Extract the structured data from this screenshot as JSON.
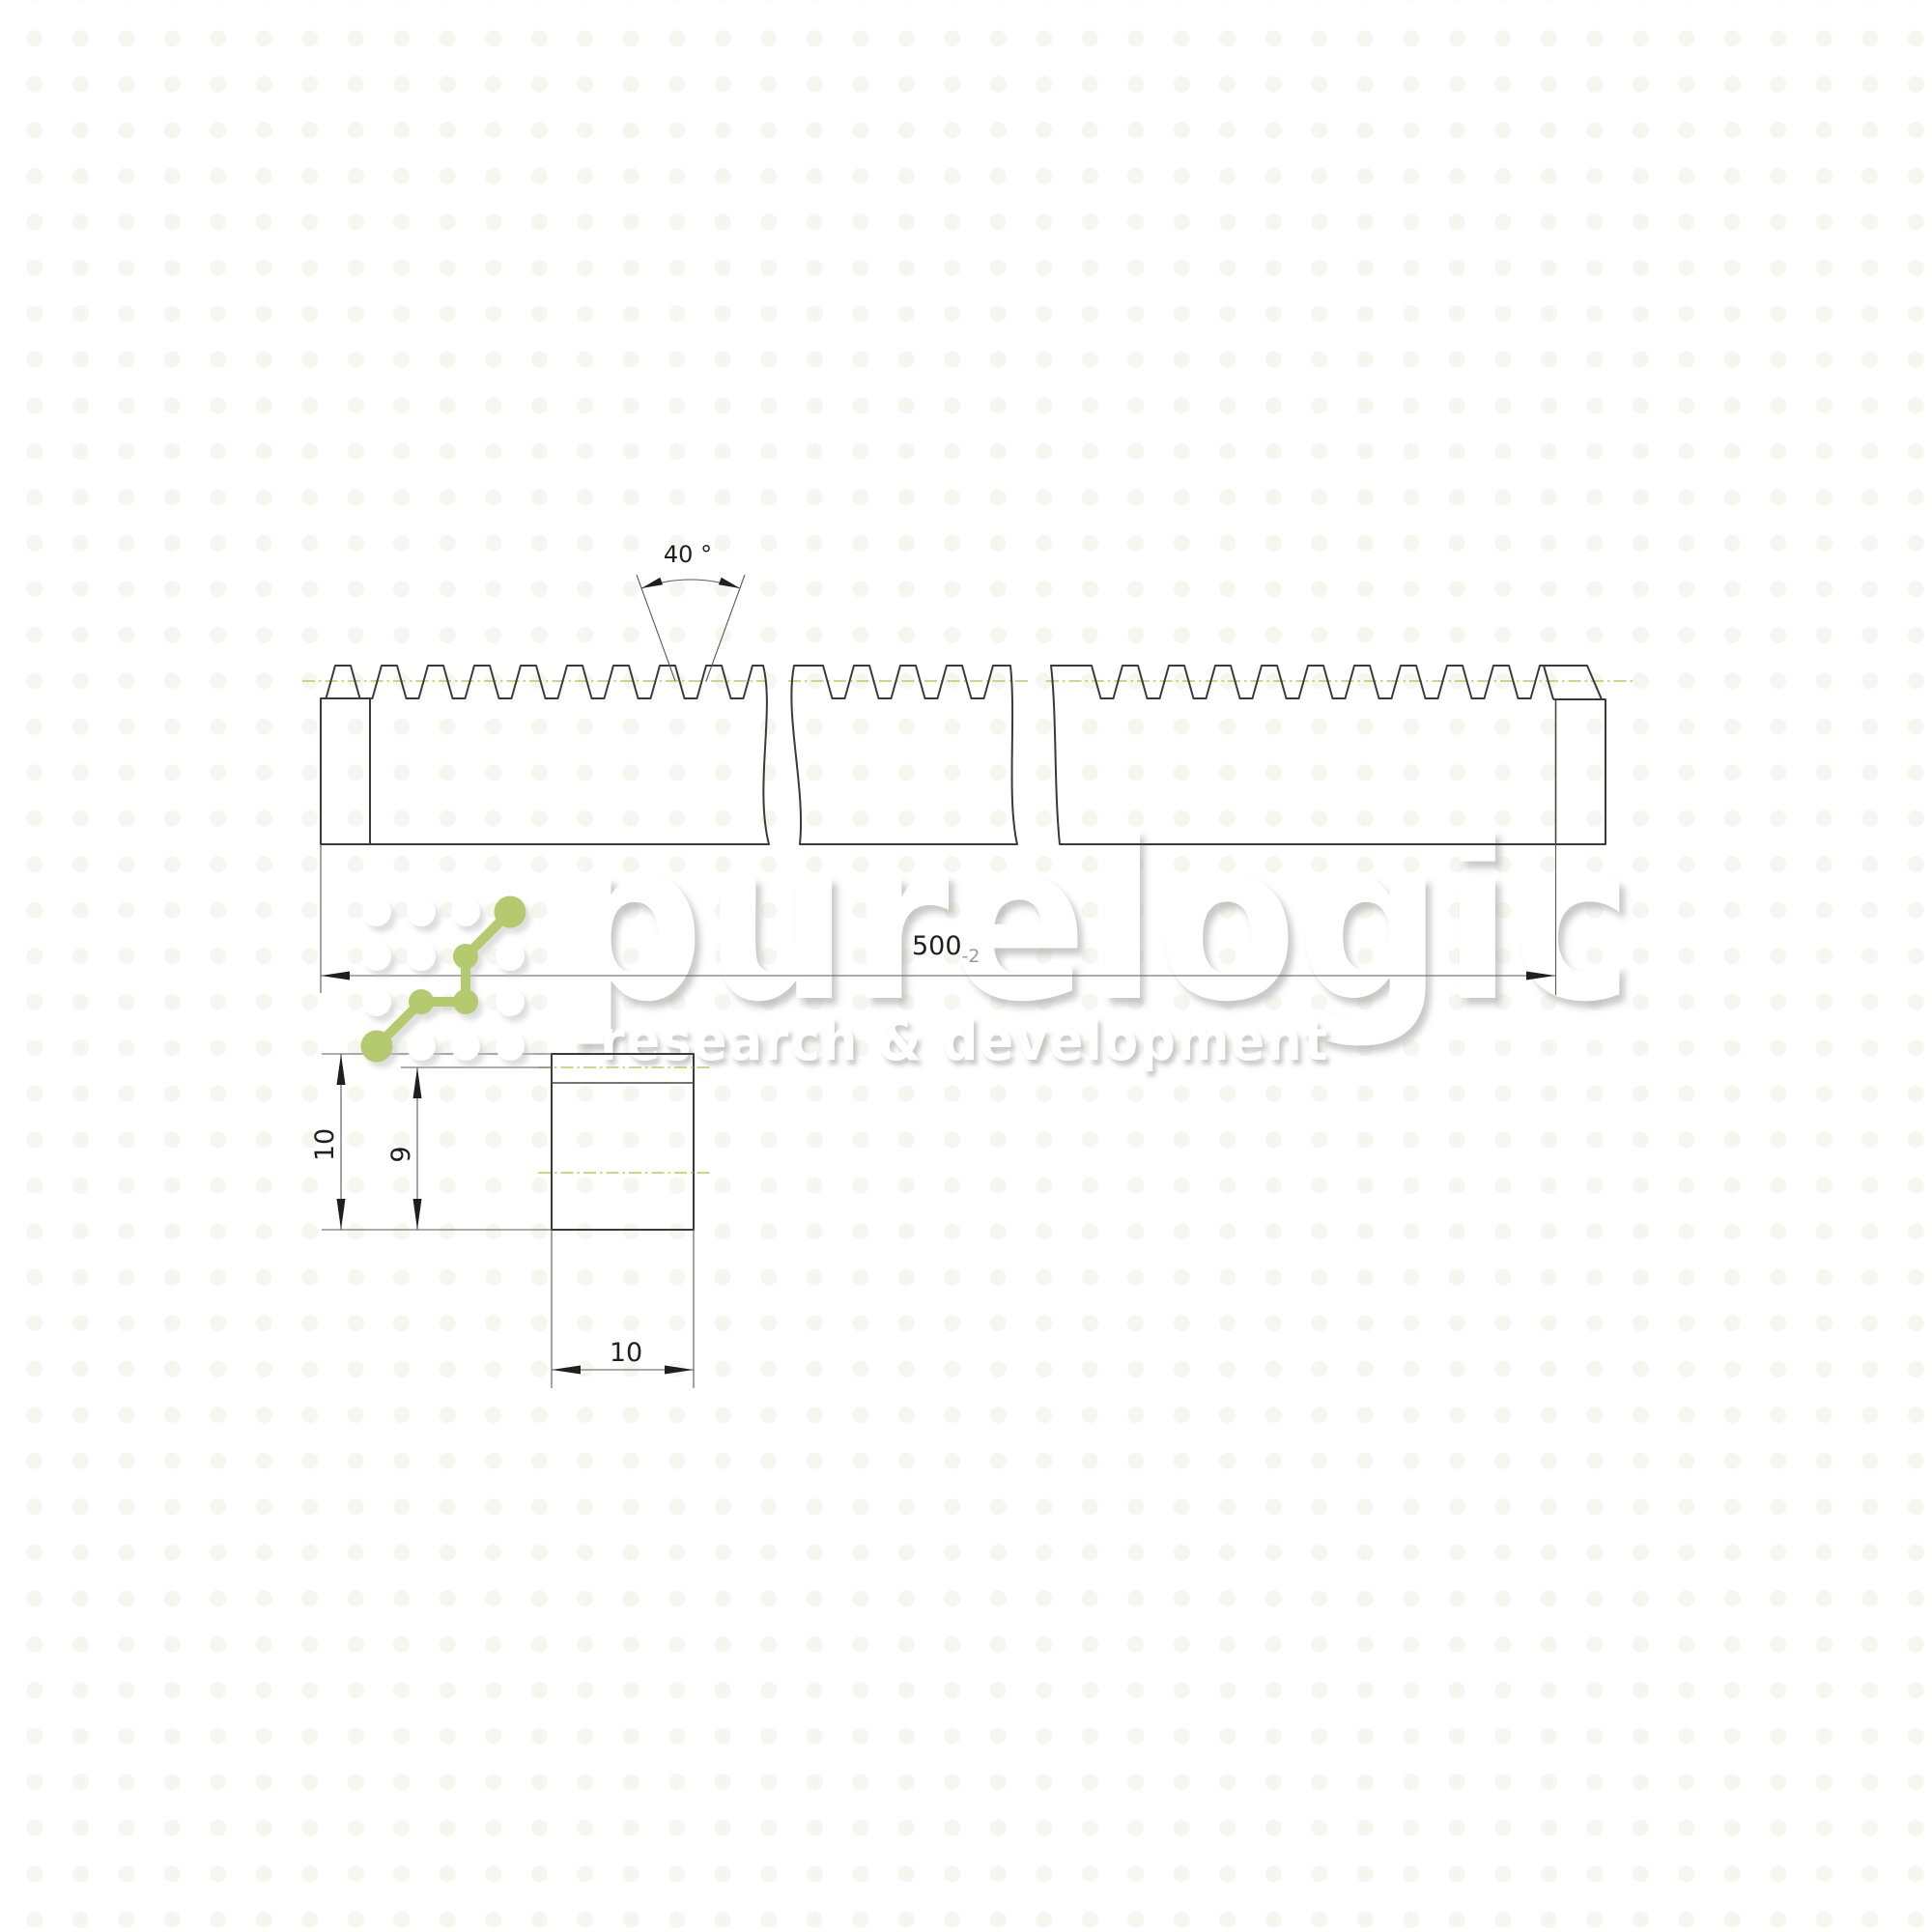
{
  "watermark": {
    "brand": "purelogic",
    "tagline": "research & development",
    "logo_green": "#b5c96e"
  },
  "dimensions": {
    "tooth_angle": "40 °",
    "length": "500",
    "length_tolerance": "-2",
    "section_height": "10",
    "section_pitch_height": "9",
    "section_width": "10"
  },
  "colors": {
    "line_dark": "#3a3a3a",
    "pitch_line": "#bfca5e",
    "tolerance_gray": "#9a9a9a"
  }
}
